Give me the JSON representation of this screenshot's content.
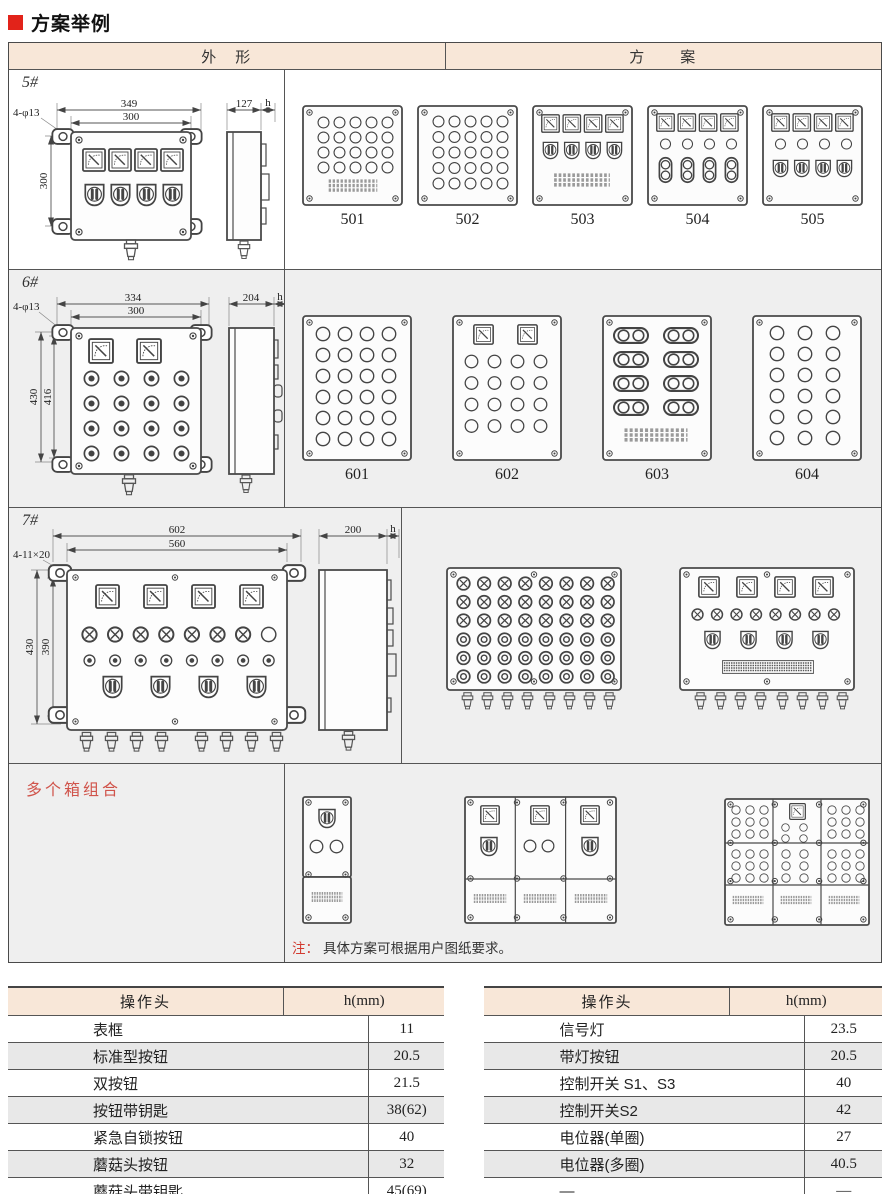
{
  "title": "方案举例",
  "colors": {
    "accent_red": "#e2231a",
    "header_bg": "#f8e7d8",
    "table_alt_row": "#e8e8e8",
    "combo_label_red": "#d0544b"
  },
  "main_table": {
    "header": {
      "shape": "外　形",
      "scheme": "方　　案"
    },
    "row5": {
      "label": "5#",
      "dims": {
        "outer_w": "349",
        "inner_w": "300",
        "height": "300",
        "holes": "4-φ13",
        "depth": "127",
        "head": "h"
      },
      "schemes": [
        "501",
        "502",
        "503",
        "504",
        "505"
      ]
    },
    "row6": {
      "label": "6#",
      "dims": {
        "outer_w": "334",
        "inner_w": "300",
        "height_outer": "430",
        "height_inner": "416",
        "holes": "4-φ13",
        "depth": "204",
        "head": "h"
      },
      "schemes": [
        "601",
        "602",
        "603",
        "604"
      ]
    },
    "row7": {
      "label": "7#",
      "dims": {
        "outer_w": "602",
        "inner_w": "560",
        "height_outer": "430",
        "height_inner": "390",
        "holes": "4-11×20",
        "depth": "200",
        "head": "h"
      }
    },
    "combo": {
      "label": "多个箱组合"
    },
    "note": {
      "prefix": "注：",
      "text": "具体方案可根据用户图纸要求。"
    }
  },
  "op_tables": [
    {
      "headers": [
        "操作头",
        "h(mm)"
      ],
      "rows": [
        [
          "表框",
          "11"
        ],
        [
          "标准型按钮",
          "20.5"
        ],
        [
          "双按钮",
          "21.5"
        ],
        [
          "按钮带钥匙",
          "38(62)"
        ],
        [
          "紧急自锁按钮",
          "40"
        ],
        [
          "蘑菇头按钮",
          "32"
        ],
        [
          "蘑菇头带钥匙",
          "45(69)"
        ]
      ]
    },
    {
      "headers": [
        "操作头",
        "h(mm)"
      ],
      "rows": [
        [
          "信号灯",
          "23.5"
        ],
        [
          "带灯按钮",
          "20.5"
        ],
        [
          "控制开关 S1、S3",
          "40"
        ],
        [
          "控制开关S2",
          "42"
        ],
        [
          "电位器(单圈)",
          "27"
        ],
        [
          "电位器(多圈)",
          "40.5"
        ],
        [
          "—",
          "—"
        ]
      ]
    }
  ]
}
